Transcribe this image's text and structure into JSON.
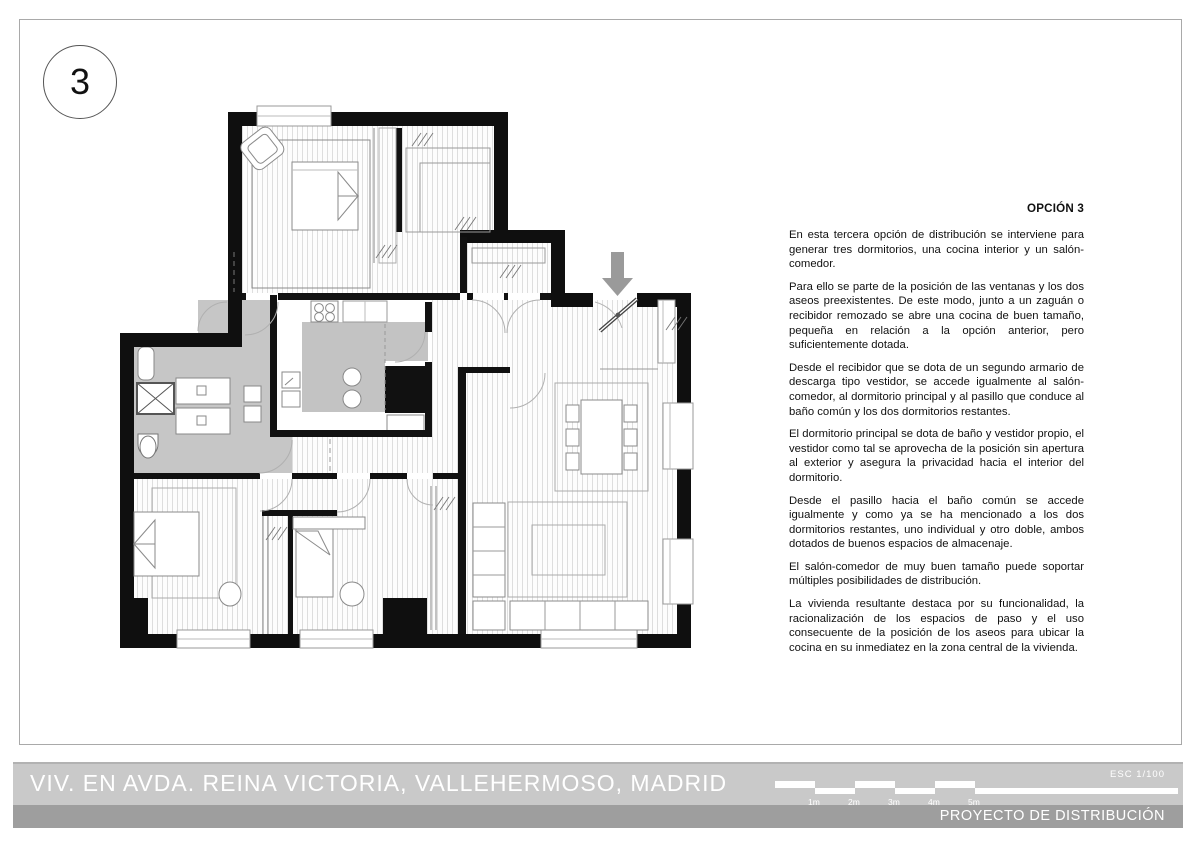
{
  "sheet": {
    "number": "3"
  },
  "text_panel": {
    "heading": "OPCIÓN 3",
    "paragraphs": [
      "En esta tercera opción de distribución se interviene para generar tres dormitorios, una cocina interior y un salón-comedor.",
      "Para ello se parte de la posición de las ventanas y los dos aseos preexistentes. De este modo, junto a un zaguán o recibidor remozado se abre una cocina de buen tamaño, pequeña en relación a la opción anterior, pero suficientemente dotada.",
      "Desde el recibidor que se dota de un segundo armario de descarga tipo vestidor, se accede igualmente al salón-comedor, al dormitorio principal y al pasillo que conduce al baño común y los dos dormitorios restantes.",
      "El dormitorio principal se dota de baño y vestidor propio, el vestidor como tal se aprovecha de la posición sin apertura al exterior y asegura la privacidad hacia el interior del dormitorio.",
      "Desde el pasillo hacia el baño común se accede igualmente y como ya se ha mencionado a los dos dormitorios restantes, uno individual y otro doble, ambos dotados de buenos espacios de almacenaje.",
      "El salón-comedor de muy buen tamaño puede soportar múltiples posibilidades de distribución.",
      "La vivienda resultante destaca por su funcionalidad, la racionalización de los espacios de paso y el uso consecuente de la posición de los aseos para ubicar la cocina en su inmediatez en la zona central de la vivienda."
    ]
  },
  "footer": {
    "title": "VIV. EN AVDA. REINA VICTORIA, VALLEHERMOSO, MADRID",
    "project": "PROYECTO DE DISTRIBUCIÓN",
    "scale_label": "ESC  1/100",
    "scale_ticks": [
      "1m",
      "2m",
      "3m",
      "4m",
      "5m"
    ]
  },
  "plan": {
    "entry_arrow_icon": "down-arrow",
    "colors": {
      "wall": "#0f0f0f",
      "wet_zone_gray": "#c6c6c6",
      "bar_light": "#c9c9c9",
      "bar_dark": "#9e9e9e",
      "arrow_gray": "#9a9a9a"
    }
  }
}
